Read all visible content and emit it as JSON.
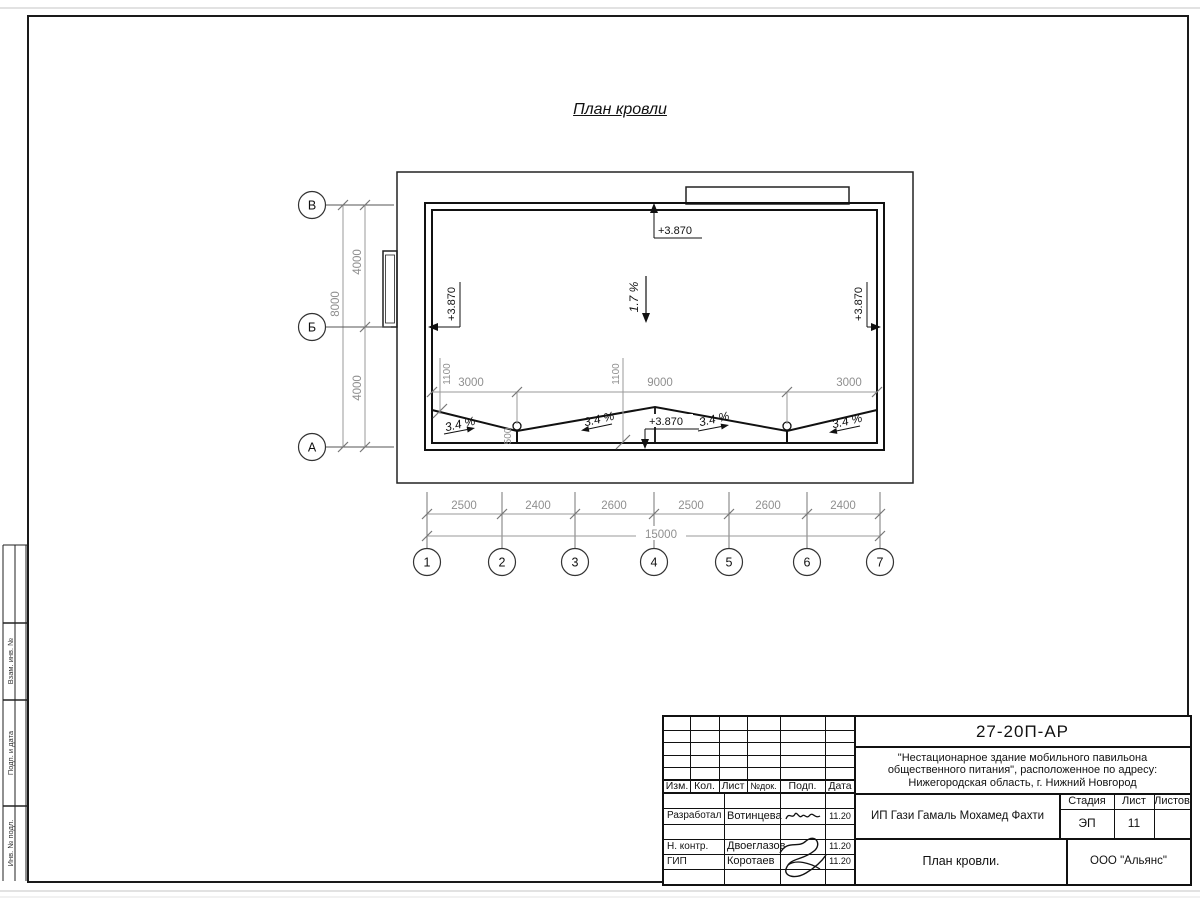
{
  "heading": "План кровли",
  "plan": {
    "row_axes": [
      "В",
      "Б",
      "А"
    ],
    "col_axes": [
      "1",
      "2",
      "3",
      "4",
      "5",
      "6",
      "7"
    ],
    "left_dims": {
      "upper": "4000",
      "lower": "4000",
      "total": "8000"
    },
    "bottom_dims": {
      "segments": [
        "2500",
        "2400",
        "2600",
        "2500",
        "2600",
        "2400"
      ],
      "total": "15000"
    },
    "roof_dims": {
      "left_1100": "1100",
      "mid_1100": "1100",
      "drop_500": "500",
      "left_3000": "3000",
      "mid_9000": "9000",
      "right_3000": "3000"
    },
    "elevations": {
      "top": "+3.870",
      "left": "+3.870",
      "right": "+3.870",
      "bottom": "+3.870"
    },
    "slopes": {
      "main": "1.7 %",
      "roof_edge": [
        "3.4 %",
        "3.4 %",
        "3.4 %",
        "3.4 %"
      ]
    }
  },
  "side_column": {
    "labels": [
      "Взам. инв. №",
      "Подп. и дата",
      "Инв. № подл."
    ]
  },
  "titleblock": {
    "doc_number": "27-20П-АР",
    "project_lines": [
      "\"Нестационарное здание мобильного павильона",
      "общественного питания\", расположенное по адресу:",
      "Нижегородская область, г. Нижний Новгород"
    ],
    "columns": {
      "izm": "Изм.",
      "kol": "Кол.",
      "list": "Лист",
      "doc": "№док.",
      "podp": "Подп.",
      "data": "Дата"
    },
    "rows": [
      {
        "role": "Разработал",
        "name": "Вотинцева",
        "date": "11.20"
      },
      {
        "role": "Н. контр.",
        "name": "Двоеглазов",
        "date": "11.20"
      },
      {
        "role": "ГИП",
        "name": "Коротаев",
        "date": "11.20"
      }
    ],
    "client": "ИП Гази Гамаль Мохамед Фахти",
    "stage": {
      "label": "Стадия",
      "value": "ЭП"
    },
    "sheet": {
      "label": "Лист",
      "value": "11"
    },
    "sheets": {
      "label": "Листов",
      "value": ""
    },
    "sheet_title": "План кровли.",
    "company": "ООО \"Альянс\""
  },
  "colors": {
    "line": "#111111",
    "dim": "#8f8f8f",
    "frame": "#1a1a1a"
  }
}
